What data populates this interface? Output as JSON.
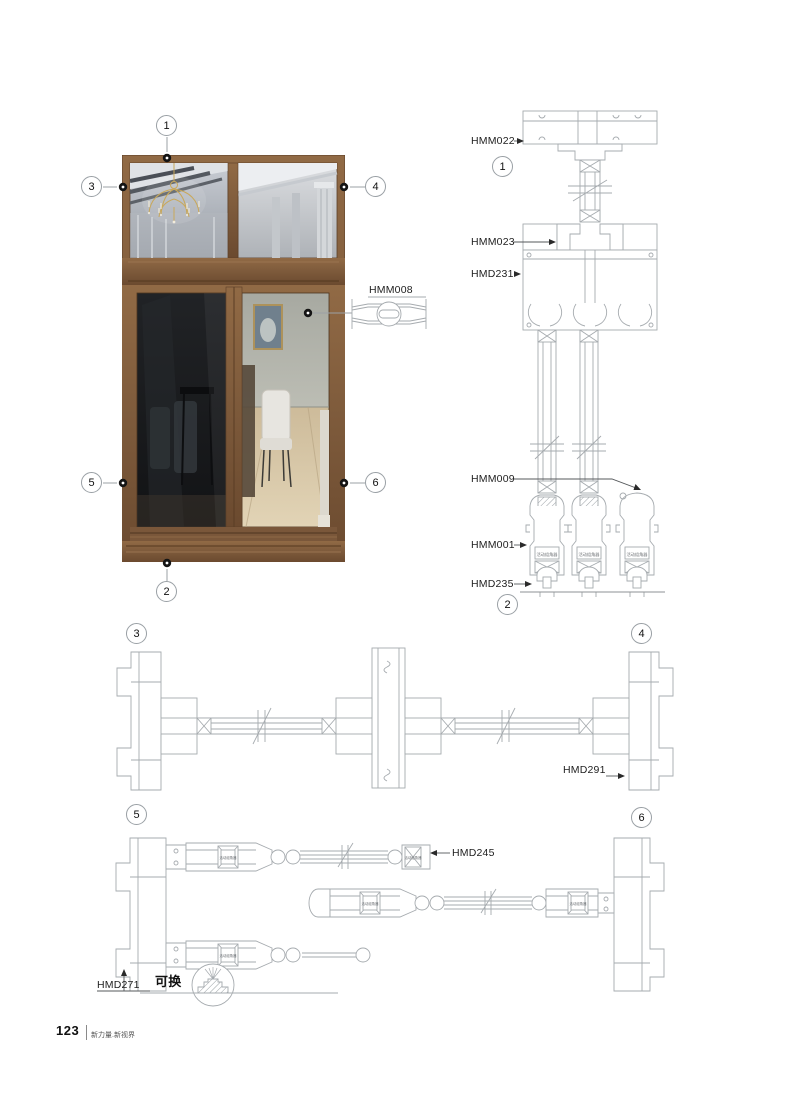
{
  "page": {
    "number": "123",
    "tagline": "新力量.新视界"
  },
  "colors": {
    "frame_brown": "#7d5a3b",
    "cad_line": "#a6abaf",
    "glass_dark": "#1b1d20"
  },
  "callouts": {
    "n1": "1",
    "n2": "2",
    "n3": "3",
    "n4": "4",
    "n5": "5",
    "n6": "6"
  },
  "labels": {
    "hmm008": "HMM008",
    "hmm022": "HMM022",
    "hmm023": "HMM023",
    "hmd231": "HMD231",
    "hmm009": "HMM009",
    "hmm001": "HMM001",
    "hmd235": "HMD235",
    "hmd291": "HMD291",
    "hmd245": "HMD245",
    "hmd271": "HMD271",
    "replaceable": "可换",
    "hardware_tag": "活动组角器"
  }
}
